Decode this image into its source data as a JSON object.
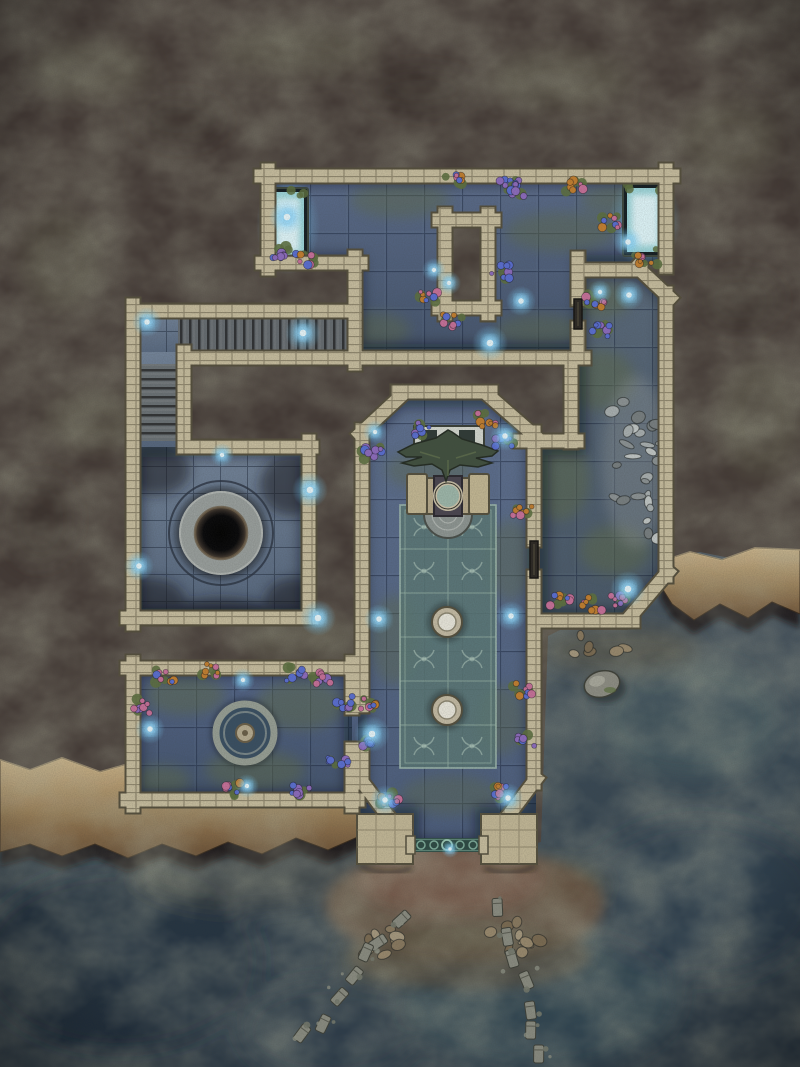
{
  "map": {
    "kind": "fantasy-dungeon-battlemap",
    "setting": "ruined-sunken-temple-on-sea-cliff",
    "width_px": 800,
    "height_px": 1067,
    "grid_size_px": 38
  },
  "palette": {
    "rock_base": "#443a36",
    "rock_lichen": "#6a6a54",
    "ocean_deep": "#263544",
    "ocean_shallow": "#4d5862",
    "ocean_teal": "#4f6a6b",
    "silt_brown": "#5d5546",
    "beach_sand": "#6b5746",
    "cliff_light": "#cdb086",
    "cliff_dark": "#6e5236",
    "wall_stone": "#c9bfa0",
    "wall_edge": "#554f3d",
    "floor_blue": "#55647f",
    "floor_grout": "#16223a",
    "moss": "#5e6c4c",
    "carpet_teal": "#5c7a78",
    "carpet_line": "#b9d2c4",
    "stone_light": "#a7adaf",
    "pit_black": "#050507",
    "glow_core": "#eafaff",
    "glow_halo": "#7fd4ff",
    "flower_pink": "#c9719b",
    "flower_blue": "#5a6fd4",
    "flower_orange": "#c5802f",
    "flower_violet": "#8e6cc0",
    "leaf_green": "#5d7040",
    "debris_gray": "#8b8d82",
    "railing_teal": "#35564f"
  },
  "features": {
    "glow_pools": [
      {
        "x": 272,
        "y": 192,
        "w": 32,
        "h": 66
      },
      {
        "x": 627,
        "y": 188,
        "w": 36,
        "h": 64
      }
    ],
    "doors": [
      {
        "x": 574,
        "y": 299,
        "w": 8,
        "h": 30
      },
      {
        "x": 530,
        "y": 541,
        "w": 8,
        "h": 37
      }
    ],
    "wisps": [
      {
        "x": 287,
        "y": 217,
        "r": 6
      },
      {
        "x": 303,
        "y": 333,
        "r": 6
      },
      {
        "x": 434,
        "y": 270,
        "r": 4
      },
      {
        "x": 449,
        "y": 283,
        "r": 4
      },
      {
        "x": 490,
        "y": 343,
        "r": 6
      },
      {
        "x": 521,
        "y": 301,
        "r": 5
      },
      {
        "x": 628,
        "y": 242,
        "r": 5
      },
      {
        "x": 629,
        "y": 295,
        "r": 5
      },
      {
        "x": 600,
        "y": 292,
        "r": 4
      },
      {
        "x": 147,
        "y": 322,
        "r": 5
      },
      {
        "x": 222,
        "y": 455,
        "r": 4
      },
      {
        "x": 310,
        "y": 490,
        "r": 6
      },
      {
        "x": 139,
        "y": 566,
        "r": 5
      },
      {
        "x": 318,
        "y": 618,
        "r": 6
      },
      {
        "x": 243,
        "y": 680,
        "r": 4
      },
      {
        "x": 150,
        "y": 729,
        "r": 5
      },
      {
        "x": 247,
        "y": 786,
        "r": 4
      },
      {
        "x": 372,
        "y": 734,
        "r": 6
      },
      {
        "x": 375,
        "y": 432,
        "r": 4
      },
      {
        "x": 505,
        "y": 436,
        "r": 5
      },
      {
        "x": 379,
        "y": 619,
        "r": 5
      },
      {
        "x": 511,
        "y": 616,
        "r": 5
      },
      {
        "x": 385,
        "y": 800,
        "r": 5
      },
      {
        "x": 508,
        "y": 798,
        "r": 5
      },
      {
        "x": 628,
        "y": 589,
        "r": 6
      },
      {
        "x": 450,
        "y": 849,
        "r": 3
      }
    ],
    "flower_clusters": [
      {
        "x": 455,
        "y": 179,
        "kind": "mixed"
      },
      {
        "x": 510,
        "y": 184,
        "kind": "blue"
      },
      {
        "x": 575,
        "y": 186,
        "kind": "orange"
      },
      {
        "x": 305,
        "y": 259,
        "kind": "mixed"
      },
      {
        "x": 282,
        "y": 252,
        "kind": "violet"
      },
      {
        "x": 430,
        "y": 298,
        "kind": "mixed"
      },
      {
        "x": 452,
        "y": 320,
        "kind": "mixed"
      },
      {
        "x": 500,
        "y": 272,
        "kind": "blue"
      },
      {
        "x": 515,
        "y": 190,
        "kind": "violet"
      },
      {
        "x": 612,
        "y": 222,
        "kind": "mixed"
      },
      {
        "x": 594,
        "y": 300,
        "kind": "mixed"
      },
      {
        "x": 600,
        "y": 330,
        "kind": "blue"
      },
      {
        "x": 648,
        "y": 262,
        "kind": "orange"
      },
      {
        "x": 372,
        "y": 452,
        "kind": "violet"
      },
      {
        "x": 420,
        "y": 430,
        "kind": "blue"
      },
      {
        "x": 487,
        "y": 420,
        "kind": "orange"
      },
      {
        "x": 505,
        "y": 440,
        "kind": "blue"
      },
      {
        "x": 523,
        "y": 512,
        "kind": "orange"
      },
      {
        "x": 523,
        "y": 690,
        "kind": "mixed"
      },
      {
        "x": 525,
        "y": 742,
        "kind": "violet"
      },
      {
        "x": 370,
        "y": 705,
        "kind": "mixed"
      },
      {
        "x": 368,
        "y": 745,
        "kind": "blue"
      },
      {
        "x": 390,
        "y": 798,
        "kind": "mixed"
      },
      {
        "x": 502,
        "y": 792,
        "kind": "mixed"
      },
      {
        "x": 165,
        "y": 676,
        "kind": "mixed"
      },
      {
        "x": 212,
        "y": 670,
        "kind": "orange"
      },
      {
        "x": 295,
        "y": 674,
        "kind": "blue"
      },
      {
        "x": 322,
        "y": 678,
        "kind": "pink"
      },
      {
        "x": 230,
        "y": 789,
        "kind": "mixed"
      },
      {
        "x": 300,
        "y": 791,
        "kind": "violet"
      },
      {
        "x": 338,
        "y": 764,
        "kind": "blue"
      },
      {
        "x": 345,
        "y": 702,
        "kind": "blue"
      },
      {
        "x": 560,
        "y": 602,
        "kind": "mixed"
      },
      {
        "x": 592,
        "y": 604,
        "kind": "orange"
      },
      {
        "x": 620,
        "y": 600,
        "kind": "pink"
      },
      {
        "x": 143,
        "y": 706,
        "kind": "pink"
      }
    ],
    "stone_piles": [
      {
        "x": 636,
        "y": 462,
        "rx": 24,
        "ry": 76,
        "count": 26,
        "kind": "rubble"
      },
      {
        "x": 378,
        "y": 942,
        "rx": 22,
        "ry": 14,
        "count": 9,
        "kind": "beach"
      },
      {
        "x": 516,
        "y": 938,
        "rx": 26,
        "ry": 16,
        "count": 10,
        "kind": "beach"
      },
      {
        "x": 600,
        "y": 645,
        "rx": 30,
        "ry": 10,
        "count": 6,
        "kind": "beach"
      }
    ],
    "debris_trails": [
      {
        "x1": 398,
        "y1": 918,
        "x2": 308,
        "y2": 1038,
        "count": 7
      },
      {
        "x1": 500,
        "y1": 910,
        "x2": 543,
        "y2": 1058,
        "count": 7
      }
    ],
    "boulders": [
      {
        "x": 602,
        "y": 684,
        "rx": 18,
        "ry": 13,
        "rot": -15
      }
    ]
  }
}
